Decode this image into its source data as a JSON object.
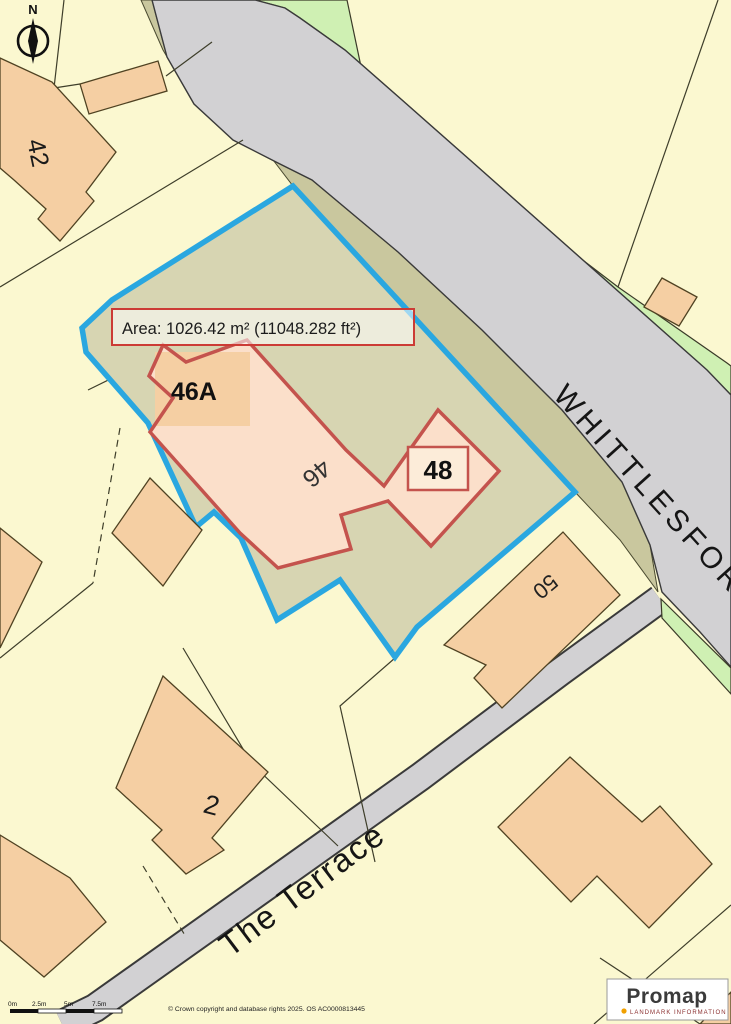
{
  "area_annotation": {
    "label": "Area: 1026.42 m² (11048.282 ft²)"
  },
  "roads": {
    "main_label": "WHITTLESFORD",
    "secondary_label": "The Terrace"
  },
  "plot_labels": {
    "n42": "42",
    "n46a": "46A",
    "n46": "46",
    "n48": "48",
    "n50": "50",
    "n2": "2"
  },
  "compass": {
    "north_label": "N"
  },
  "scale_bar": {
    "ticks": [
      "0m",
      "2.5m",
      "5m",
      "7.5m"
    ]
  },
  "footer": {
    "copyright": "© Crown copyright and database rights 2025. OS AC0000813445"
  },
  "logo": {
    "brand": "Promap",
    "tagline": "LANDMARK INFORMATION"
  },
  "colors": {
    "site_boundary_blue": "#2AA7E0",
    "plot_outline_red": "#C4534D",
    "building_fill": "#F5CFA3",
    "inner_building_fill": "#FBDFCA",
    "site_fill": "#D7D5B2",
    "road_fill": "#D2D1D3",
    "verge_fill": "#C9C79E",
    "green_strip_fill": "#CFF0B3",
    "background": "#FBF8D0"
  }
}
